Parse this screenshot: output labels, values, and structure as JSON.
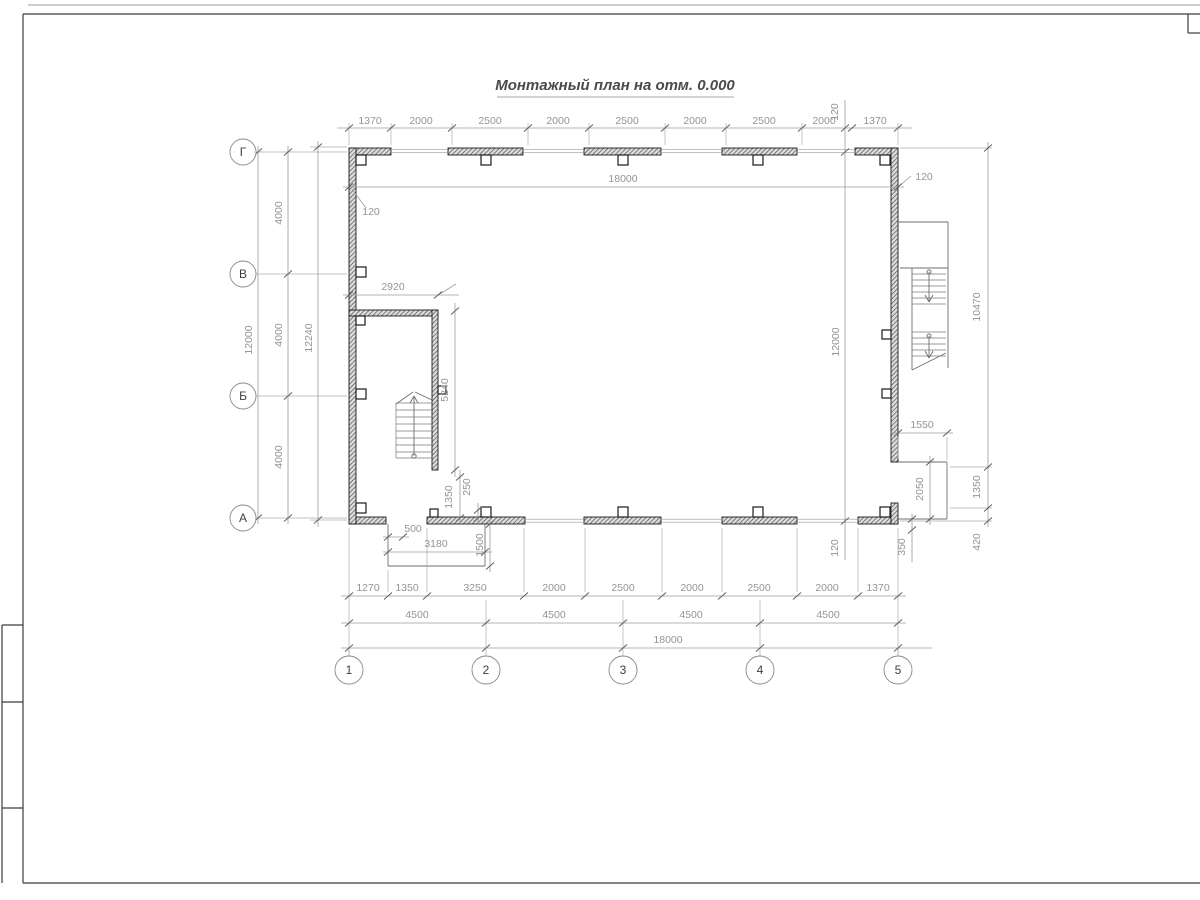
{
  "title": "Монтажный план на отм. 0.000",
  "axes": {
    "rows": [
      "Г",
      "В",
      "Б",
      "А"
    ],
    "cols": [
      "1",
      "2",
      "3",
      "4",
      "5"
    ]
  },
  "dims": {
    "top_chain": [
      "1370",
      "2000",
      "2500",
      "2000",
      "2500",
      "2000",
      "2500",
      "2000",
      "1370"
    ],
    "top_overall": "18000",
    "wall_left": "120",
    "wall_right": "120",
    "col_line_top": "120",
    "col_line_mid": "12000",
    "col_line_bottom": "120",
    "left_spans": [
      "4000",
      "4000",
      "4000"
    ],
    "left_grid": "12000",
    "left_overall": "12240",
    "right_chain": [
      "10470",
      "1350",
      "420"
    ],
    "right_porch_width": "1550",
    "right_porch_depth": "2050",
    "right_step": "350",
    "bottom_row1": [
      "1270",
      "1350",
      "3250",
      "2000",
      "2500",
      "2000",
      "2500",
      "2000",
      "1370"
    ],
    "bottom_row2": [
      "4500",
      "4500",
      "4500",
      "4500"
    ],
    "bottom_overall": "18000",
    "stair_width": "2920",
    "stair_length": "5240",
    "stair_exit": "1350",
    "stair_offset": "250",
    "porch_offset": "500",
    "porch_width": "3180",
    "porch_depth": "1500"
  },
  "colors": {
    "wall_line": "#1a1a1a",
    "dim_line": "#9b9b9b",
    "dim_text": "#949494"
  }
}
